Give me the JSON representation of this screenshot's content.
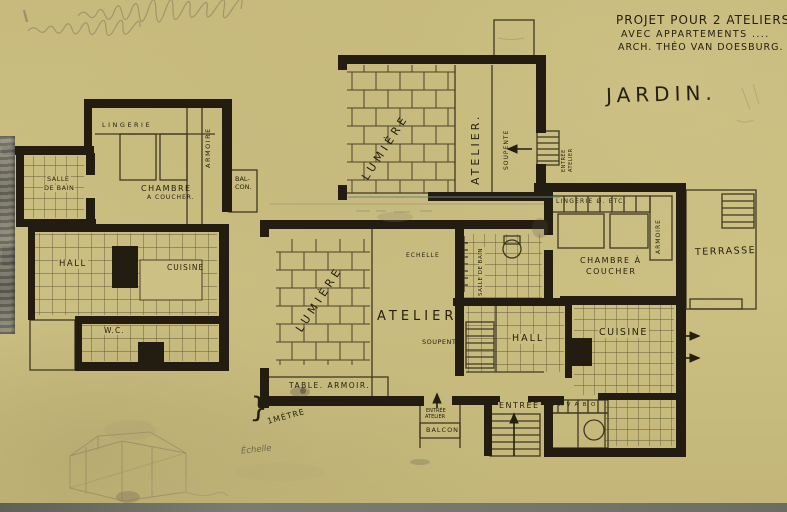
{
  "title_block": {
    "line1": "PROJET POUR 2 ATELIERS",
    "line2": "AVEC APPARTEMENTS ....",
    "line3": "ARCH. THÉO VAN DOESBURG."
  },
  "jardin": "JARDIN.",
  "colors": {
    "paper": "#c9bc7e",
    "ink": "#241f10",
    "pencil": "#7b745c",
    "tape": "#8b8a7e",
    "teal_line": "#5d8a80"
  },
  "rooms": {
    "lingerie_left": "LINGERIE",
    "armoire_left": "ARMOIRE",
    "chambre_left_line1": "CHAMBRE",
    "chambre_left_line2": "A COUCHER.",
    "balcon_line1": "BAL-",
    "balcon_line2": "CON.",
    "salle_bain_left_line1": "SALLE",
    "salle_bain_left_line2": "DE BAIN",
    "hall_left": "HALL",
    "cuisine_left": "CUISINE",
    "wc": "W.C.",
    "lumiere_upper": "LUMIÈRE",
    "atelier_upper": "ATELIER.",
    "soupente_upper": "SOUPENTE",
    "entree_atelier_upper_line1": "ENTRÉE",
    "entree_atelier_upper_line2": "ATELIER",
    "lingerie_right": "LINGERIE Ø. ETC.",
    "armoire_right": "ARMOIRE",
    "chambre_right_line1": "CHAMBRE À",
    "chambre_right_line2": "COUCHER",
    "terrasse": "TERRASSE",
    "salle_bain_center": "SALLE DE BAIN",
    "hall_right": "HALL",
    "cuisine_right": "CUISINE",
    "lumiere_lower": "LUMIÈRE",
    "atelier_lower": "ATELIER",
    "echelle_ladder": "ECHELLE",
    "soupente_lower": "SOUPENTE",
    "table_armoir": "TABLE. ARMOIR.",
    "entree_balcon_line1": "ENTRÉE",
    "entree_balcon_line2": "ATELIER",
    "balcon_lower": "BALCON",
    "entree_right": "ENTRÉE",
    "lavabo": "LAVABO",
    "scale_brace": "}",
    "scale_metre": "1MÈTRE",
    "echelle_script": "Échelle"
  }
}
